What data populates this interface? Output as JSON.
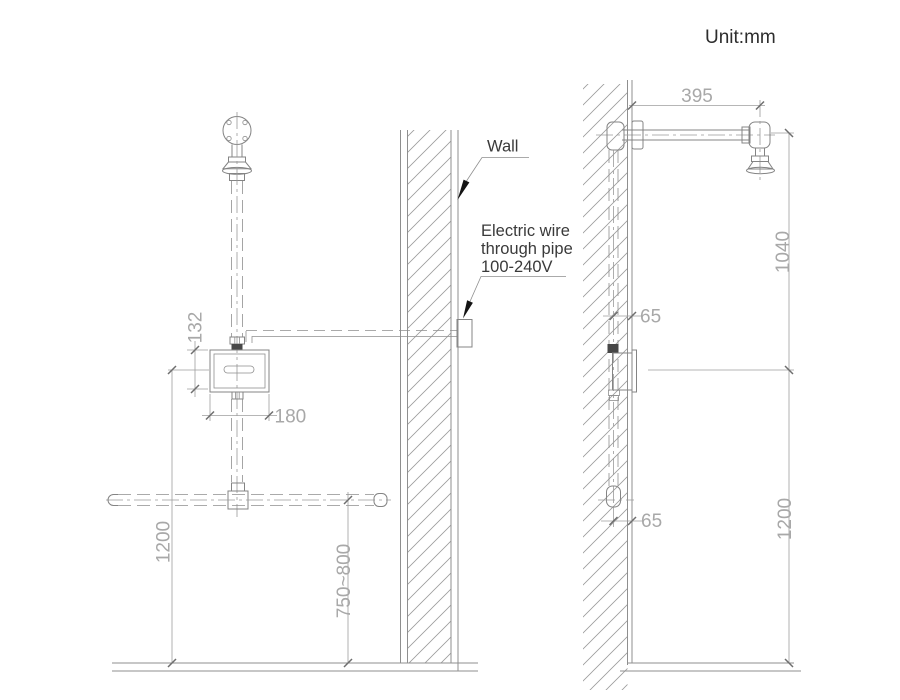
{
  "meta": {
    "unit_label": "Unit:mm"
  },
  "labels": {
    "wall": "Wall",
    "electric_wire_line1": "Electric wire",
    "electric_wire_line2": "through pipe",
    "electric_wire_line3": "100-240V"
  },
  "dimensions": {
    "front": {
      "sensor_box_height": "132",
      "sensor_box_width": "180",
      "sensor_center_to_floor": "1200",
      "supply_pipe_to_floor": "750~800"
    },
    "side": {
      "shower_arm_length": "395",
      "arm_to_sensor_center": "1040",
      "sensor_center_to_floor": "1200",
      "top_pipe_to_wall_face": "65",
      "bottom_pipe_to_wall_face": "65"
    }
  },
  "colors": {
    "background": "#ffffff",
    "drawing_line": "#8a8a8a",
    "dimension_text": "#a8a8a8",
    "label_text": "#3a3a3a",
    "leader_arrow": "#141414",
    "hatch": "#9c9c9c"
  }
}
